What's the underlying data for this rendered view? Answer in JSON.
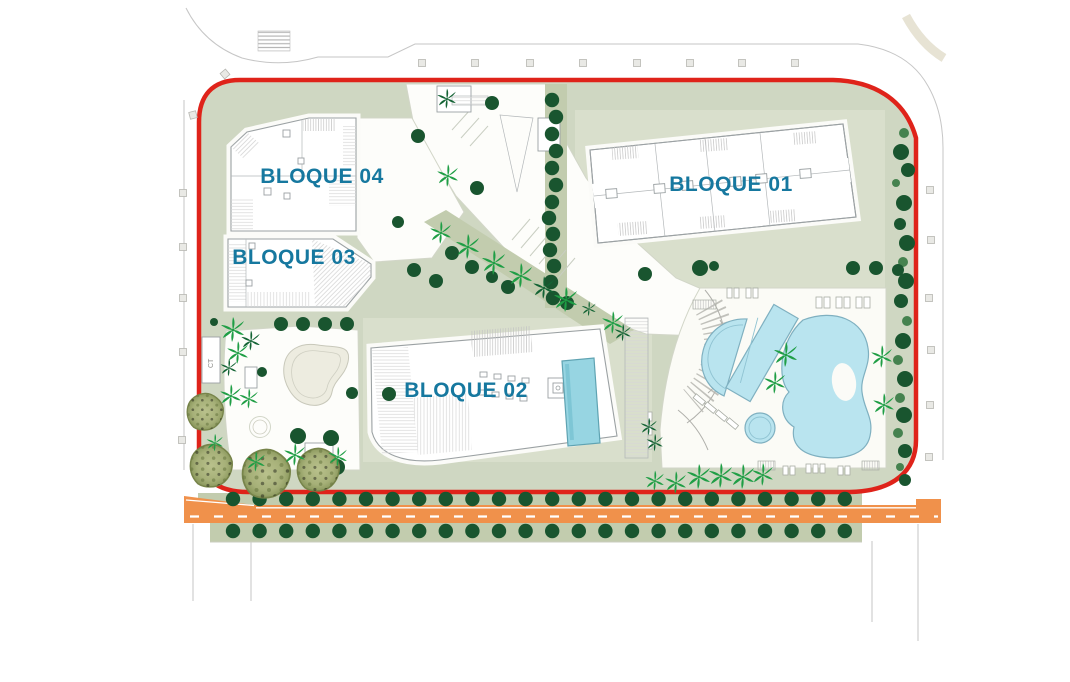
{
  "plan": {
    "blocks": [
      {
        "id": "bloque-01",
        "label": "BLOQUE 01",
        "x": 731,
        "y": 191
      },
      {
        "id": "bloque-02",
        "label": "BLOQUE 02",
        "x": 466,
        "y": 397
      },
      {
        "id": "bloque-03",
        "label": "BLOQUE 03",
        "x": 294,
        "y": 264
      },
      {
        "id": "bloque-04",
        "label": "BLOQUE 04",
        "x": 322,
        "y": 183
      }
    ],
    "ct_label": "CT",
    "colors": {
      "boundary_red": "#df231a",
      "label_teal": "#16789f",
      "site_green": "#cfd7c2",
      "strip_green": "#c2ccae",
      "plot_green": "#d9dfcc",
      "road_orange": "#f0914b",
      "pool_blue": "#b9e4ef",
      "rooftop_pool": "#97d5e2",
      "tree_dark": "#19552f",
      "tree_mid": "#45824f",
      "palm_bright": "#1f9e45",
      "palm_dark": "#136334",
      "olive_fill": "#aab378",
      "street_gray": "#c6c6c6",
      "building_stroke": "#9ba1a3"
    },
    "trees": {
      "road_rows": {
        "x_start": 233,
        "x_step": 26.6,
        "count": 24,
        "y_upper": 499,
        "y_lower": 531,
        "r": 7.2
      },
      "right_column": [
        [
          904,
          133,
          5,
          "mid"
        ],
        [
          901,
          152,
          8,
          "dark"
        ],
        [
          908,
          170,
          7,
          "dark"
        ],
        [
          896,
          183,
          4,
          "mid"
        ],
        [
          904,
          203,
          8,
          "dark"
        ],
        [
          900,
          224,
          6,
          "dark"
        ],
        [
          907,
          243,
          8,
          "dark"
        ],
        [
          903,
          262,
          5,
          "mid"
        ],
        [
          906,
          281,
          8,
          "dark"
        ],
        [
          901,
          301,
          7,
          "dark"
        ],
        [
          907,
          321,
          5,
          "mid"
        ],
        [
          903,
          341,
          8,
          "dark"
        ],
        [
          898,
          360,
          5,
          "mid"
        ],
        [
          905,
          379,
          8,
          "dark"
        ],
        [
          900,
          398,
          5,
          "mid"
        ],
        [
          904,
          415,
          8,
          "dark"
        ],
        [
          898,
          433,
          5,
          "mid"
        ],
        [
          905,
          451,
          7,
          "dark"
        ],
        [
          900,
          467,
          4,
          "mid"
        ],
        [
          905,
          480,
          6,
          "dark"
        ]
      ],
      "center_column": [
        [
          552,
          100
        ],
        [
          556,
          117
        ],
        [
          552,
          134
        ],
        [
          556,
          151
        ],
        [
          552,
          168
        ],
        [
          556,
          185
        ],
        [
          552,
          202
        ],
        [
          549,
          218
        ],
        [
          553,
          234
        ],
        [
          550,
          250
        ],
        [
          554,
          266
        ],
        [
          551,
          282
        ],
        [
          553,
          298
        ]
      ],
      "scattered": [
        [
          418,
          136,
          7
        ],
        [
          477,
          188,
          7
        ],
        [
          492,
          103,
          7
        ],
        [
          398,
          222,
          6
        ],
        [
          414,
          270,
          7
        ],
        [
          436,
          281,
          7
        ],
        [
          452,
          253,
          7
        ],
        [
          472,
          267,
          7
        ],
        [
          492,
          277,
          6
        ],
        [
          508,
          287,
          7
        ],
        [
          567,
          303,
          7
        ],
        [
          645,
          274,
          7
        ],
        [
          700,
          268,
          8
        ],
        [
          714,
          266,
          5
        ],
        [
          853,
          268,
          7
        ],
        [
          876,
          268,
          7
        ],
        [
          898,
          270,
          6
        ],
        [
          281,
          324,
          7
        ],
        [
          303,
          324,
          7
        ],
        [
          325,
          324,
          7
        ],
        [
          347,
          324,
          7
        ],
        [
          214,
          322,
          4
        ],
        [
          262,
          372,
          5
        ],
        [
          298,
          436,
          8
        ],
        [
          331,
          438,
          8
        ],
        [
          352,
          393,
          6
        ],
        [
          389,
          394,
          7
        ],
        [
          337,
          467,
          8
        ]
      ],
      "palms": [
        [
          447,
          99,
          0.8,
          "dark"
        ],
        [
          448,
          176,
          0.9,
          "bright"
        ],
        [
          441,
          233,
          0.9,
          "bright"
        ],
        [
          468,
          247,
          1,
          "bright"
        ],
        [
          494,
          263,
          1,
          "bright"
        ],
        [
          521,
          276,
          1,
          "bright"
        ],
        [
          544,
          288,
          0.9,
          "dark"
        ],
        [
          566,
          300,
          1,
          "bright"
        ],
        [
          589,
          309,
          0.6,
          "dark"
        ],
        [
          613,
          323,
          0.9,
          "bright"
        ],
        [
          623,
          333,
          0.7,
          "dark"
        ],
        [
          233,
          330,
          1,
          "bright"
        ],
        [
          251,
          341,
          0.8,
          "dark"
        ],
        [
          238,
          353,
          0.9,
          "bright"
        ],
        [
          229,
          368,
          0.7,
          "dark"
        ],
        [
          231,
          396,
          0.9,
          "bright"
        ],
        [
          249,
          399,
          0.8,
          "bright"
        ],
        [
          295,
          455,
          0.9,
          "bright"
        ],
        [
          256,
          462,
          0.8,
          "bright"
        ],
        [
          338,
          457,
          0.8,
          "bright"
        ],
        [
          215,
          443,
          0.7,
          "bright"
        ],
        [
          786,
          355,
          1,
          "bright"
        ],
        [
          775,
          383,
          0.9,
          "bright"
        ],
        [
          882,
          357,
          0.9,
          "bright"
        ],
        [
          884,
          405,
          0.9,
          "bright"
        ],
        [
          649,
          427,
          0.7,
          "dark"
        ],
        [
          655,
          443,
          0.7,
          "dark"
        ],
        [
          655,
          481,
          0.8,
          "bright"
        ],
        [
          676,
          483,
          0.9,
          "bright"
        ],
        [
          699,
          477,
          1,
          "bright"
        ],
        [
          721,
          476,
          1,
          "bright"
        ],
        [
          743,
          477,
          1,
          "bright"
        ],
        [
          763,
          475,
          0.9,
          "bright"
        ]
      ],
      "olives": [
        [
          205,
          412,
          19
        ],
        [
          211,
          466,
          22
        ],
        [
          266,
          474,
          25
        ],
        [
          318,
          470,
          22
        ]
      ]
    },
    "street_squares": {
      "top_y": 63,
      "top_x": [
        422,
        475,
        530,
        583,
        637,
        690,
        742,
        795
      ],
      "right": [
        [
          930,
          190
        ],
        [
          931,
          240
        ],
        [
          929,
          298
        ],
        [
          931,
          350
        ],
        [
          930,
          405
        ],
        [
          929,
          457
        ]
      ],
      "left": [
        [
          225,
          74,
          -40
        ],
        [
          193,
          115,
          -15
        ],
        [
          183,
          193,
          0
        ],
        [
          183,
          247,
          0
        ],
        [
          183,
          298,
          0
        ],
        [
          183,
          352,
          0
        ],
        [
          182,
          440,
          0
        ]
      ]
    }
  }
}
